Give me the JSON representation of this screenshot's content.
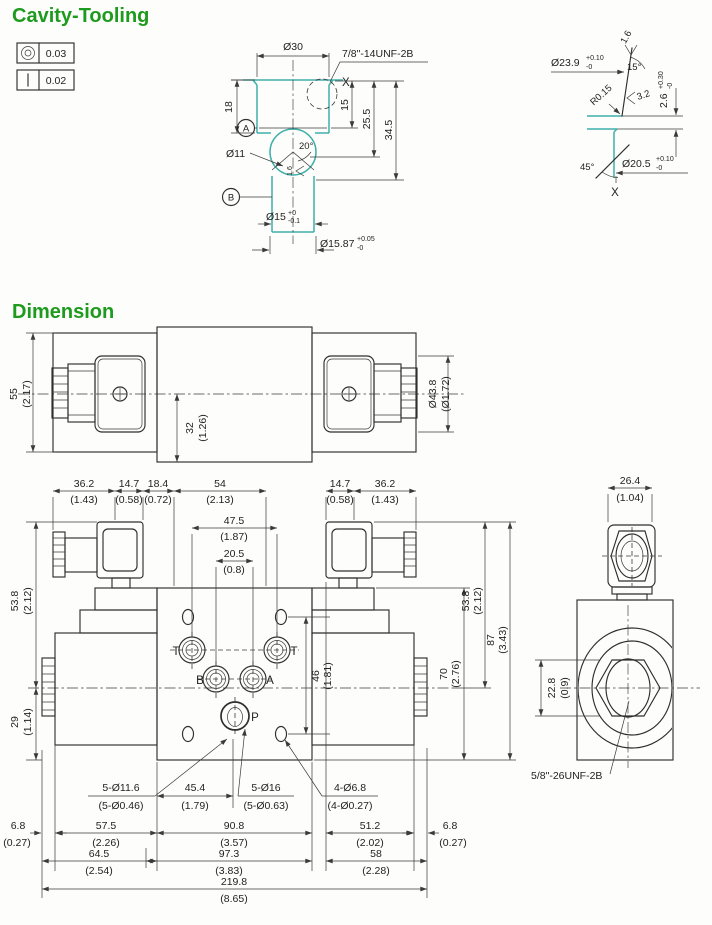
{
  "titles": {
    "cavity": "Cavity-Tooling",
    "dimension": "Dimension"
  },
  "colors": {
    "accent_green": "#1e9b1e",
    "cavity_teal": "#3fb0aa",
    "line": "#2f2f2f"
  },
  "tolerances": {
    "concentricity_value": "0.03",
    "straightness_value": "0.02"
  },
  "cavity": {
    "dia30": "Ø30",
    "thread": "7/8\"-14UNF-2B",
    "x_mark": "X",
    "d18": "18",
    "d15": "15",
    "d25_5": "25.5",
    "d34_5": "34.5",
    "datum_a": "A",
    "datum_b": "B",
    "dia11": "Ø11",
    "a20": "20°",
    "f16": "1.6",
    "dia15": "Ø15",
    "dia15_sup": "+0",
    "dia15_sub": "-0.1",
    "dia1587": "Ø15.87",
    "dia1587_sup": "+0.05",
    "dia1587_sub": "-0"
  },
  "detail": {
    "f16": "1.6",
    "dia239": "Ø23.9",
    "dia239_sup": "+0.10",
    "dia239_sub": "-0",
    "a15": "15°",
    "r015": "R0.15",
    "f32": "3.2",
    "d26": "2.6",
    "d26_sup": "+0.30",
    "d26_sub": "-0",
    "a45": "45°",
    "dia205": "Ø20.5",
    "dia205_sup": "+0.10",
    "dia205_sub": "-0",
    "x_mark": "X"
  },
  "top": {
    "d55": "55",
    "d55i": "(2.17)",
    "d32": "32",
    "d32i": "(1.26)",
    "dia438": "Ø43.8",
    "dia438i": "(Ø1.72)"
  },
  "front": {
    "t36l": "36.2",
    "t36li": "(1.43)",
    "t14l": "14.7",
    "t14li": "(0.58)",
    "t184": "18.4",
    "t184i": "(0.72)",
    "t54": "54",
    "t54i": "(2.13)",
    "t475": "47.5",
    "t475i": "(1.87)",
    "t205": "20.5",
    "t205i": "(0.8)",
    "t14r": "14.7",
    "t14ri": "(0.58)",
    "t36r": "36.2",
    "t36ri": "(1.43)",
    "l538": "53.8",
    "l538i": "(2.12)",
    "l29": "29",
    "l29i": "(1.14)",
    "r46": "46",
    "r46i": "(1.81)",
    "r538": "53.8",
    "r538i": "(2.12)",
    "r70": "70",
    "r70i": "(2.76)",
    "r87": "87",
    "r87i": "(3.43)",
    "port_t_left": "T",
    "port_t_right": "T",
    "port_b": "B",
    "port_a": "A",
    "port_p": "P",
    "c116": "5-Ø11.6",
    "c116i": "(5-Ø0.46)",
    "c454": "45.4",
    "c454i": "(1.79)",
    "c16": "5-Ø16",
    "c16i": "(5-Ø0.63)",
    "c68": "4-Ø6.8",
    "c68i": "(4-Ø0.27)",
    "b68l": "6.8",
    "b68li": "(0.27)",
    "b575": "57.5",
    "b575i": "(2.26)",
    "b908": "90.8",
    "b908i": "(3.57)",
    "b512": "51.2",
    "b512i": "(2.02)",
    "b68r": "6.8",
    "b68ri": "(0.27)",
    "b645": "64.5",
    "b645i": "(2.54)",
    "b973": "97.3",
    "b973i": "(3.83)",
    "b58": "58",
    "b58i": "(2.28)",
    "b2198": "219.8",
    "b2198i": "(8.65)"
  },
  "side": {
    "w264": "26.4",
    "w264i": "(1.04)",
    "h228": "22.8",
    "h228i": "(0.9)",
    "thread": "5/8\"-26UNF-2B"
  }
}
